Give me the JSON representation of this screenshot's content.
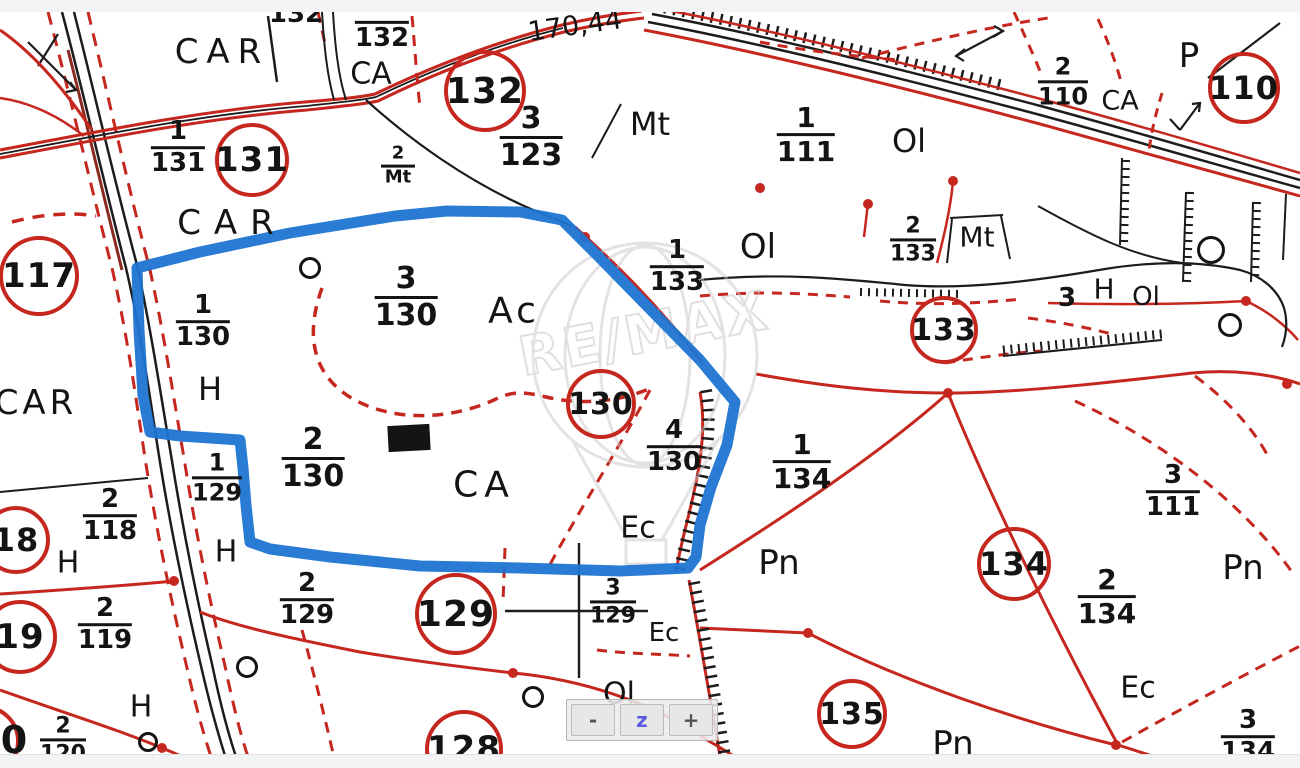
{
  "colors": {
    "parcel_red": "#c5271f",
    "ink_black": "#1c1c1c",
    "highlight_blue": "#1f74d2",
    "watermark_gray": "#cccccc",
    "page_background": "#f1f3f4",
    "map_background": "#ffffff"
  },
  "watermark": {
    "text": "RE/MAX"
  },
  "zoom_control": {
    "minus": "-",
    "zoom": "z",
    "plus": "+"
  },
  "map": {
    "circles": [
      {
        "label": "132",
        "x": 485,
        "y": 91,
        "d": 74,
        "fs": 36
      },
      {
        "label": "131",
        "x": 252,
        "y": 160,
        "d": 66,
        "fs": 34
      },
      {
        "label": "110",
        "x": 1244,
        "y": 88,
        "d": 64,
        "fs": 32
      },
      {
        "label": "117",
        "x": 39,
        "y": 276,
        "d": 72,
        "fs": 34
      },
      {
        "label": "130",
        "x": 601,
        "y": 404,
        "d": 62,
        "fs": 30
      },
      {
        "label": "133",
        "x": 944,
        "y": 330,
        "d": 60,
        "fs": 30
      },
      {
        "label": "134",
        "x": 1014,
        "y": 564,
        "d": 66,
        "fs": 32
      },
      {
        "label": "135",
        "x": 852,
        "y": 714,
        "d": 62,
        "fs": 30
      },
      {
        "label": "129",
        "x": 456,
        "y": 614,
        "d": 74,
        "fs": 36
      },
      {
        "label": "128",
        "x": 464,
        "y": 749,
        "d": 70,
        "fs": 34
      },
      {
        "label": "18",
        "x": 16,
        "y": 540,
        "d": 60,
        "fs": 32
      },
      {
        "label": "19",
        "x": 20,
        "y": 637,
        "d": 66,
        "fs": 34
      },
      {
        "label": "",
        "x": -16,
        "y": 741,
        "d": 64,
        "fs": 34
      }
    ],
    "fractions": [
      {
        "n": "1",
        "d": "131",
        "x": 178,
        "y": 148,
        "fs": 26
      },
      {
        "n": "",
        "d": "132",
        "x": 382,
        "y": 36,
        "fs": 26
      },
      {
        "n": "3",
        "d": "123",
        "x": 531,
        "y": 137,
        "fs": 30
      },
      {
        "n": "1",
        "d": "111",
        "x": 806,
        "y": 135,
        "fs": 28
      },
      {
        "n": "2",
        "d": "110",
        "x": 1063,
        "y": 82,
        "fs": 24
      },
      {
        "n": "2",
        "d": "Mt",
        "x": 398,
        "y": 166,
        "fs": 18
      },
      {
        "n": "1",
        "d": "133",
        "x": 677,
        "y": 267,
        "fs": 26
      },
      {
        "n": "2",
        "d": "133",
        "x": 913,
        "y": 240,
        "fs": 22
      },
      {
        "n": "1",
        "d": "130",
        "x": 203,
        "y": 322,
        "fs": 26
      },
      {
        "n": "3",
        "d": "130",
        "x": 406,
        "y": 297,
        "fs": 30
      },
      {
        "n": "2",
        "d": "130",
        "x": 313,
        "y": 458,
        "fs": 30
      },
      {
        "n": "4",
        "d": "130",
        "x": 674,
        "y": 447,
        "fs": 26
      },
      {
        "n": "1",
        "d": "134",
        "x": 802,
        "y": 462,
        "fs": 28
      },
      {
        "n": "3",
        "d": "111",
        "x": 1173,
        "y": 492,
        "fs": 26
      },
      {
        "n": "2",
        "d": "134",
        "x": 1107,
        "y": 597,
        "fs": 28
      },
      {
        "n": "3",
        "d": "134",
        "x": 1248,
        "y": 737,
        "fs": 26
      },
      {
        "n": "2",
        "d": "118",
        "x": 110,
        "y": 516,
        "fs": 26
      },
      {
        "n": "1",
        "d": "129",
        "x": 217,
        "y": 478,
        "fs": 24
      },
      {
        "n": "2",
        "d": "119",
        "x": 105,
        "y": 625,
        "fs": 26
      },
      {
        "n": "2",
        "d": "120",
        "x": 63,
        "y": 740,
        "fs": 22
      },
      {
        "n": "2",
        "d": "129",
        "x": 307,
        "y": 600,
        "fs": 26
      },
      {
        "n": "3",
        "d": "129",
        "x": 613,
        "y": 602,
        "fs": 22
      }
    ],
    "labels": [
      {
        "t": "CAR",
        "x": 222,
        "y": 52,
        "fs": 34,
        "ls": 8
      },
      {
        "t": "132",
        "x": 296,
        "y": 14,
        "fs": 26,
        "fw": 600
      },
      {
        "t": "CA",
        "x": 371,
        "y": 74,
        "fs": 30
      },
      {
        "t": "170,44",
        "x": 575,
        "y": 26,
        "fs": 27,
        "rot": -8
      },
      {
        "t": "Mt",
        "x": 650,
        "y": 124,
        "fs": 32
      },
      {
        "t": "Ol",
        "x": 909,
        "y": 141,
        "fs": 32
      },
      {
        "t": "CA",
        "x": 1120,
        "y": 101,
        "fs": 27
      },
      {
        "t": "P",
        "x": 1189,
        "y": 56,
        "fs": 34
      },
      {
        "t": "CAR",
        "x": 232,
        "y": 223,
        "fs": 34,
        "ls": 13
      },
      {
        "t": "Ol",
        "x": 758,
        "y": 247,
        "fs": 34
      },
      {
        "t": "Mt",
        "x": 977,
        "y": 237,
        "fs": 28
      },
      {
        "t": "3",
        "x": 1067,
        "y": 298,
        "fs": 26,
        "fw": 600
      },
      {
        "t": "H",
        "x": 1104,
        "y": 289,
        "fs": 28
      },
      {
        "t": "Ol",
        "x": 1146,
        "y": 297,
        "fs": 26
      },
      {
        "t": "Ac",
        "x": 514,
        "y": 311,
        "fs": 36,
        "ls": 4
      },
      {
        "t": "H",
        "x": 210,
        "y": 389,
        "fs": 32
      },
      {
        "t": "CAR",
        "x": 36,
        "y": 403,
        "fs": 34,
        "ls": 4
      },
      {
        "t": "CA",
        "x": 484,
        "y": 485,
        "fs": 36,
        "ls": 6
      },
      {
        "t": "Ec",
        "x": 638,
        "y": 528,
        "fs": 30
      },
      {
        "t": "Pn",
        "x": 779,
        "y": 563,
        "fs": 34
      },
      {
        "t": "Pn",
        "x": 1243,
        "y": 568,
        "fs": 34
      },
      {
        "t": "H",
        "x": 68,
        "y": 563,
        "fs": 30
      },
      {
        "t": "H",
        "x": 226,
        "y": 552,
        "fs": 30
      },
      {
        "t": "Ec",
        "x": 664,
        "y": 633,
        "fs": 26
      },
      {
        "t": "Ol",
        "x": 619,
        "y": 694,
        "fs": 30
      },
      {
        "t": "H",
        "x": 141,
        "y": 707,
        "fs": 30
      },
      {
        "t": "Ec",
        "x": 1138,
        "y": 688,
        "fs": 30
      },
      {
        "t": "Pn",
        "x": 953,
        "y": 744,
        "fs": 34
      },
      {
        "t": "0",
        "x": 14,
        "y": 740,
        "fs": 38,
        "fw": 700
      }
    ],
    "rings": [
      {
        "x": 310,
        "y": 268,
        "r": 8
      },
      {
        "x": 247,
        "y": 667,
        "r": 8
      },
      {
        "x": 533,
        "y": 697,
        "r": 8
      },
      {
        "x": 148,
        "y": 742,
        "r": 7
      },
      {
        "x": 1211,
        "y": 250,
        "r": 11
      },
      {
        "x": 1230,
        "y": 325,
        "r": 9
      }
    ]
  }
}
